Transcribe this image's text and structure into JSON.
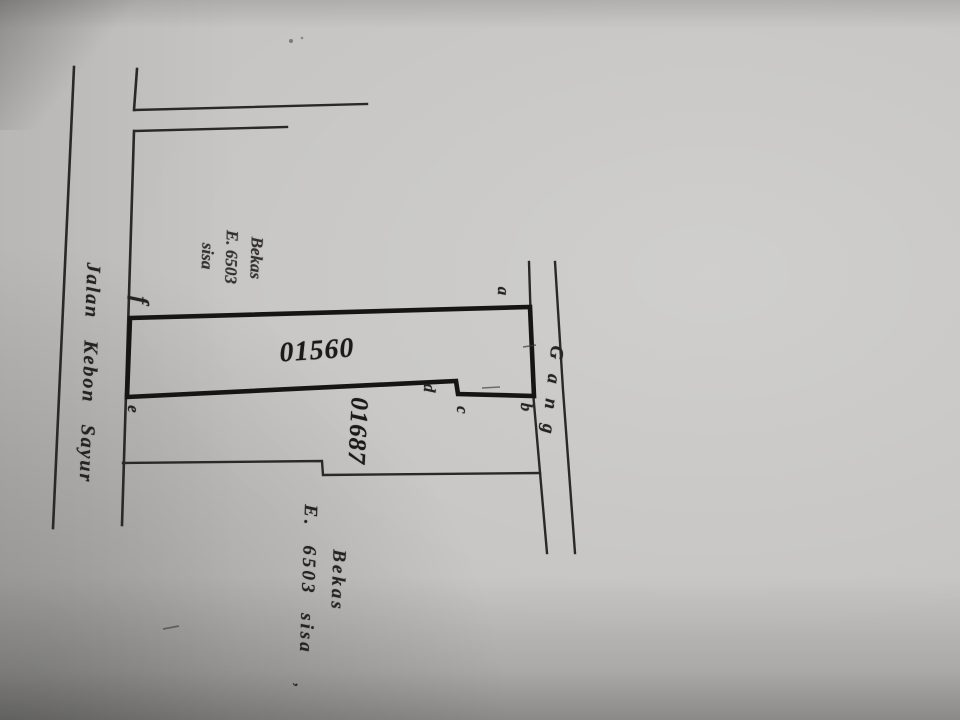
{
  "map": {
    "road_name": "Jalan Kebon Sayur",
    "alley_label": "Gang",
    "parcels": {
      "main_number": "01560",
      "adjacent_number": "01687"
    },
    "upper_left_note": {
      "line1": "Bekas",
      "line2": "E. 6503",
      "line3": "sisa"
    },
    "lower_right_note": {
      "line1": "Bekas",
      "line2": "E. 6503 sisa"
    },
    "corner_letters": [
      "a",
      "b",
      "c",
      "d",
      "e",
      "f"
    ],
    "stray_mark": ","
  },
  "colors": {
    "paper": "#c6c5c3",
    "ink_thin": "#2a2927",
    "ink_thick": "#161514"
  }
}
